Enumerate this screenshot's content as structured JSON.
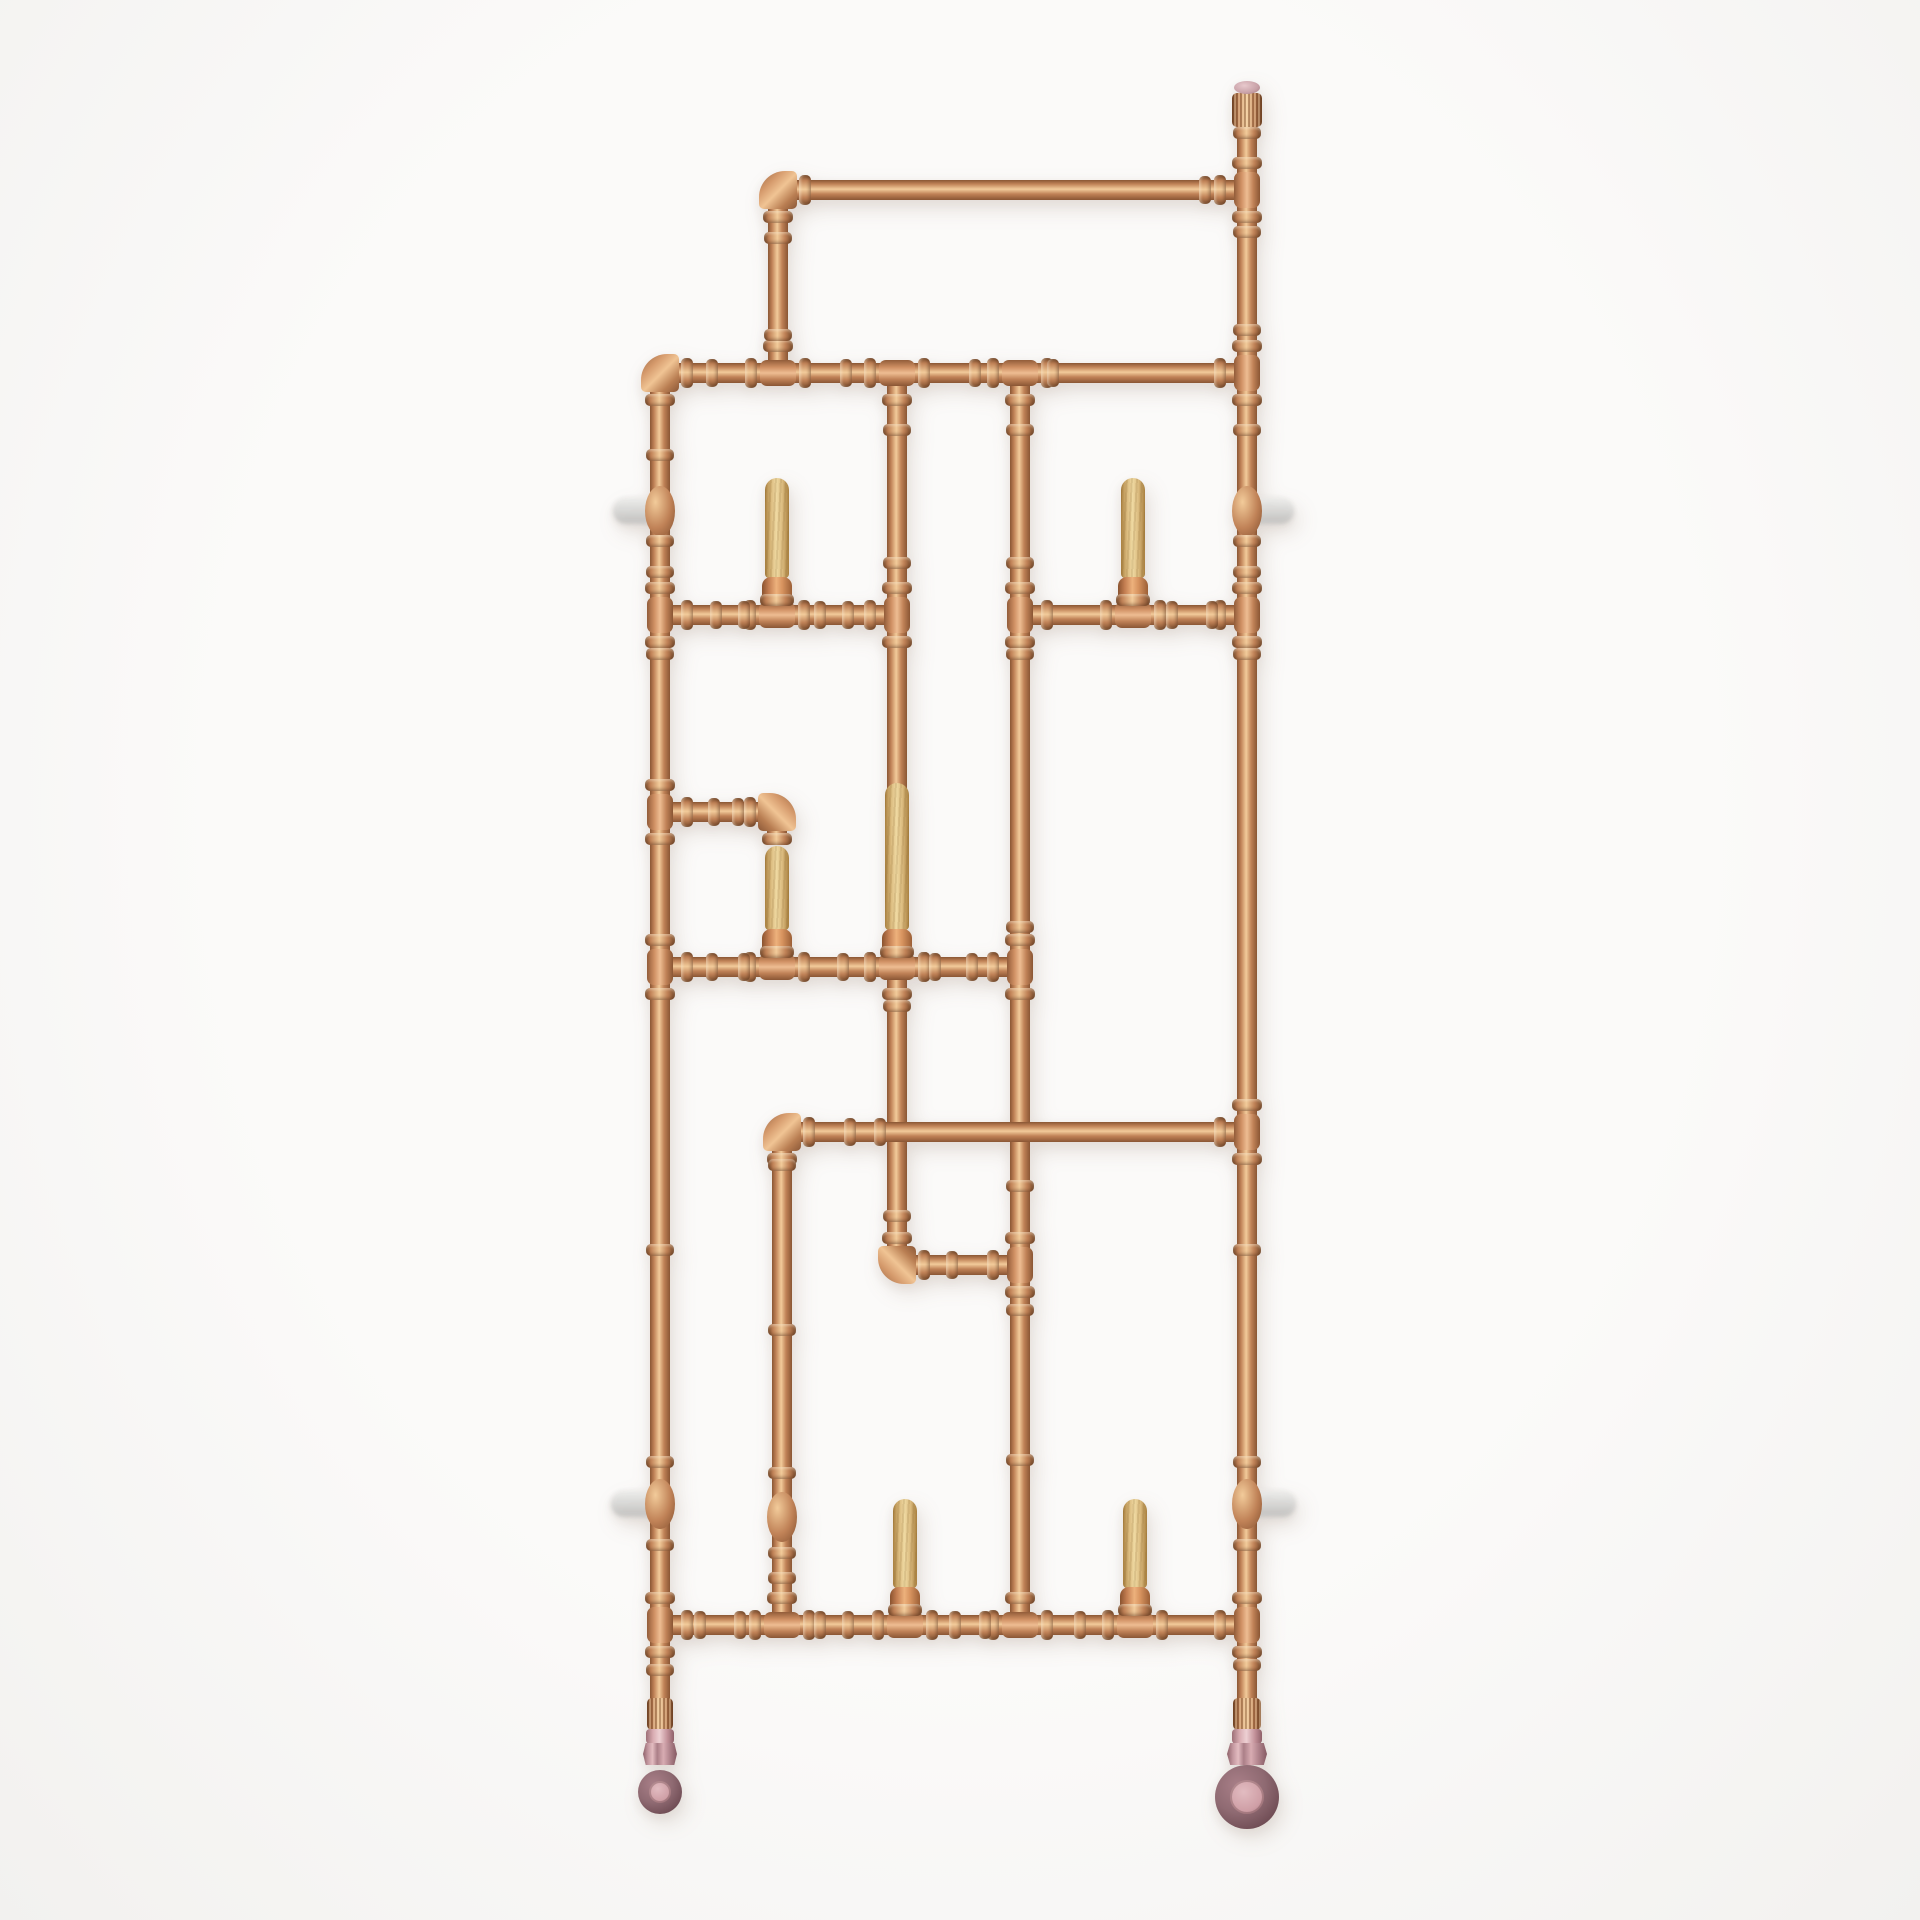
{
  "scene": {
    "label": "Industrial copper pipe wall coat rack with wooden pegs and rose caster wheels on white background"
  },
  "palette": {
    "bg": "#fbfaf9",
    "copper_dark": "#8a5634",
    "copper_dark2": "#7c4e2e",
    "copper_mid": "#c08257",
    "copper_highlight": "#f2cb9a",
    "wood_dark": "#a9803f",
    "wood_mid": "#dcbc80",
    "wood_highlight": "#efd9a2",
    "rose_cap": "#c9a2a8",
    "wheel_outer": "#8f6a72",
    "wheel_rim": "#6e4b53",
    "wheel_hub": "#cf9fa6",
    "nut_pink": "#c498a0",
    "collar_pink": "#d8abb1",
    "bracket_grey": "#d6d6d4"
  },
  "geometry": {
    "pipe_w": 20,
    "pipes_v": [
      [
        660,
        373,
        1330
      ],
      [
        1247,
        95,
        1605
      ],
      [
        778,
        190,
        183
      ],
      [
        897,
        373,
        417
      ],
      [
        897,
        967,
        298
      ],
      [
        1020,
        373,
        1252
      ],
      [
        782,
        1132,
        493
      ],
      [
        777,
        812,
        26
      ]
    ],
    "pipes_h": [
      [
        778,
        190,
        469
      ],
      [
        660,
        373,
        587
      ],
      [
        660,
        615,
        237
      ],
      [
        1020,
        615,
        227
      ],
      [
        660,
        812,
        117
      ],
      [
        660,
        967,
        360
      ],
      [
        782,
        1132,
        465
      ],
      [
        897,
        1265,
        123
      ],
      [
        660,
        1625,
        587
      ]
    ],
    "elbows": [
      [
        778,
        190,
        "nw"
      ],
      [
        660,
        373,
        "nw"
      ],
      [
        777,
        812,
        "ne"
      ],
      [
        782,
        1132,
        "nw"
      ],
      [
        897,
        1265,
        "sw"
      ]
    ],
    "tees": [
      [
        1247,
        190,
        "left"
      ],
      [
        778,
        373,
        "up"
      ],
      [
        897,
        373,
        "down"
      ],
      [
        1020,
        373,
        "down"
      ],
      [
        1247,
        373,
        "left"
      ],
      [
        660,
        615,
        "right"
      ],
      [
        777,
        615,
        "up"
      ],
      [
        897,
        615,
        "left"
      ],
      [
        1020,
        615,
        "right"
      ],
      [
        1133,
        615,
        "up"
      ],
      [
        1247,
        615,
        "left"
      ],
      [
        660,
        812,
        "right"
      ],
      [
        660,
        967,
        "right"
      ],
      [
        777,
        967,
        "up"
      ],
      [
        897,
        967,
        "up"
      ],
      [
        897,
        967,
        "down"
      ],
      [
        1020,
        967,
        "left"
      ],
      [
        1247,
        1132,
        "left"
      ],
      [
        1020,
        1265,
        "left"
      ],
      [
        660,
        1625,
        "right"
      ],
      [
        782,
        1625,
        "up"
      ],
      [
        905,
        1625,
        "up"
      ],
      [
        1020,
        1625,
        "up"
      ],
      [
        1135,
        1625,
        "up"
      ],
      [
        1247,
        1625,
        "left"
      ]
    ],
    "couplers_v": [
      [
        660,
        455
      ],
      [
        660,
        541
      ],
      [
        660,
        572
      ],
      [
        660,
        654
      ],
      [
        660,
        1250
      ],
      [
        660,
        1462
      ],
      [
        660,
        1545
      ],
      [
        660,
        1670
      ],
      [
        1247,
        133
      ],
      [
        1247,
        232
      ],
      [
        1247,
        330
      ],
      [
        1247,
        430
      ],
      [
        1247,
        541
      ],
      [
        1247,
        572
      ],
      [
        1247,
        654
      ],
      [
        1247,
        1250
      ],
      [
        1247,
        1462
      ],
      [
        1247,
        1545
      ],
      [
        1247,
        1665
      ],
      [
        778,
        238
      ],
      [
        778,
        335
      ],
      [
        897,
        430
      ],
      [
        897,
        563
      ],
      [
        897,
        1006
      ],
      [
        897,
        1216
      ],
      [
        1020,
        430
      ],
      [
        1020,
        563
      ],
      [
        1020,
        654
      ],
      [
        1020,
        927
      ],
      [
        1020,
        1186
      ],
      [
        1020,
        1310
      ],
      [
        1020,
        1460
      ],
      [
        782,
        1165
      ],
      [
        782,
        1330
      ],
      [
        782,
        1473
      ],
      [
        782,
        1553
      ],
      [
        782,
        1578
      ]
    ],
    "couplers_h": [
      [
        1205,
        190
      ],
      [
        712,
        373
      ],
      [
        846,
        373
      ],
      [
        975,
        373
      ],
      [
        1053,
        373
      ],
      [
        716,
        615
      ],
      [
        744,
        615
      ],
      [
        820,
        615
      ],
      [
        848,
        615
      ],
      [
        1172,
        615
      ],
      [
        1212,
        615
      ],
      [
        714,
        812
      ],
      [
        738,
        812
      ],
      [
        712,
        967
      ],
      [
        744,
        967
      ],
      [
        843,
        967
      ],
      [
        935,
        967
      ],
      [
        972,
        967
      ],
      [
        850,
        1132
      ],
      [
        880,
        1132
      ],
      [
        952,
        1265
      ],
      [
        700,
        1625
      ],
      [
        740,
        1625
      ],
      [
        820,
        1625
      ],
      [
        848,
        1625
      ],
      [
        955,
        1625
      ],
      [
        985,
        1625
      ],
      [
        1080,
        1625
      ],
      [
        1108,
        1625
      ]
    ],
    "pegs": [
      [
        777,
        478,
        615
      ],
      [
        1133,
        478,
        615
      ],
      [
        777,
        846,
        967
      ],
      [
        897,
        783,
        967
      ],
      [
        905,
        1499,
        1625
      ],
      [
        1135,
        1499,
        1625
      ]
    ],
    "brackets": [
      [
        636,
        511,
        "left"
      ],
      [
        1271,
        511,
        "right"
      ],
      [
        634,
        1504,
        "left"
      ],
      [
        1273,
        1504,
        "right"
      ]
    ],
    "bulges": [
      [
        660,
        511
      ],
      [
        1247,
        511
      ],
      [
        660,
        1504
      ],
      [
        1247,
        1504
      ],
      [
        782,
        1517
      ]
    ],
    "cap": [
      1247,
      87
    ],
    "casters": [
      {
        "x": 660,
        "knurl_w": 26,
        "collar_w": 28,
        "nut_w": 34,
        "wheel_cy": 1792,
        "wheel_r": 22,
        "hub_r": 11
      },
      {
        "x": 1247,
        "knurl_w": 28,
        "collar_w": 30,
        "nut_w": 40,
        "wheel_cy": 1797,
        "wheel_r": 32,
        "hub_r": 17
      }
    ]
  }
}
